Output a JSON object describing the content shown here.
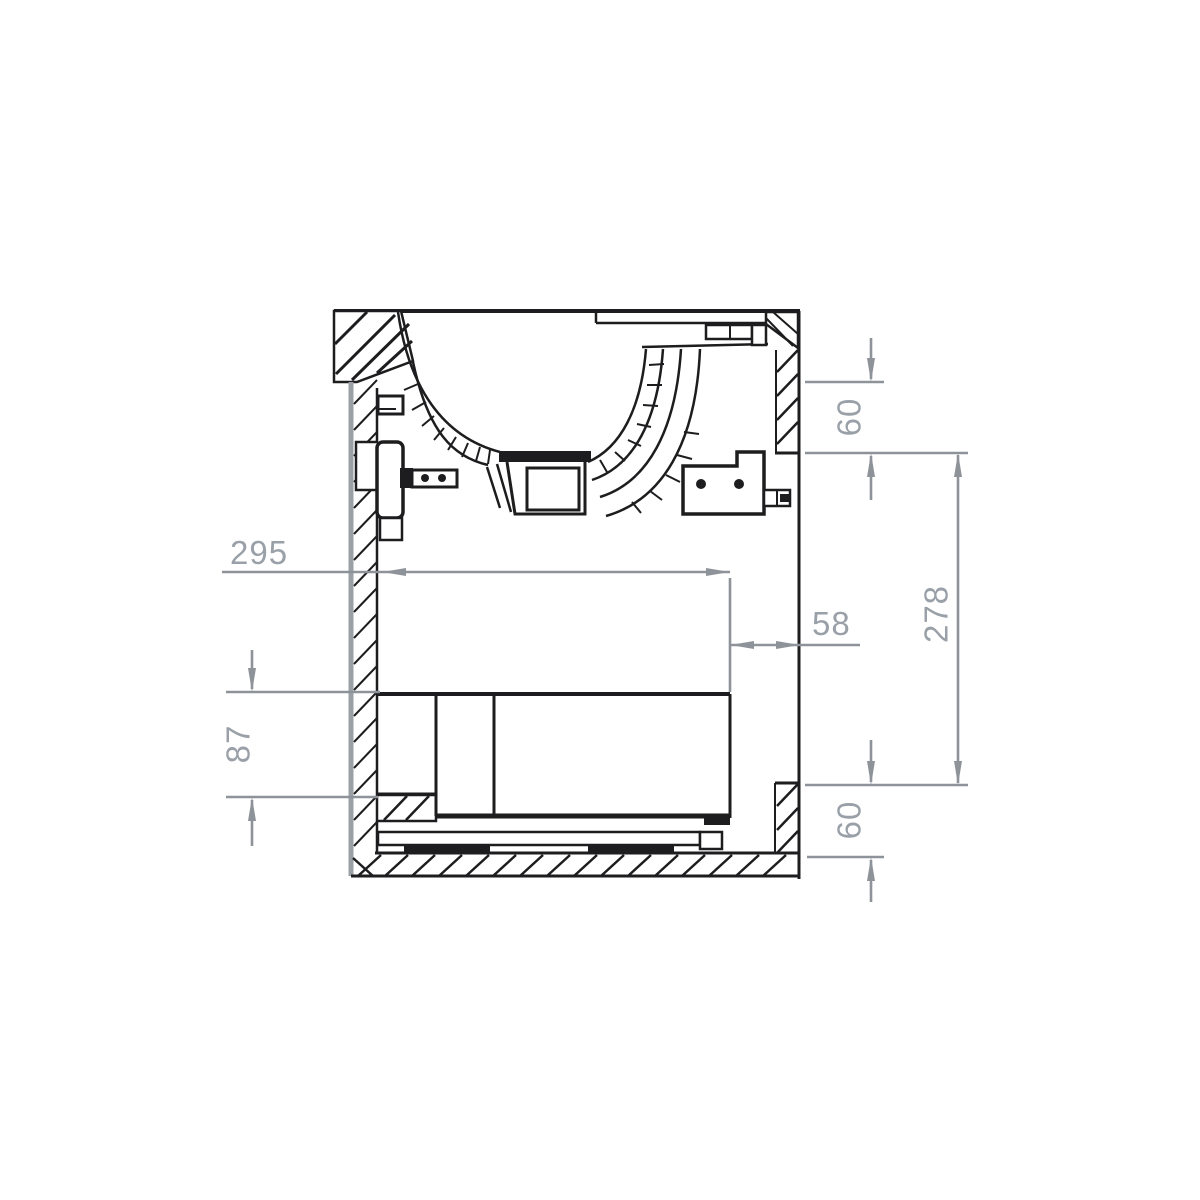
{
  "drawing": {
    "dimension_labels": {
      "basin_width": "295",
      "back_panel_offset": "58",
      "interior_height": "278",
      "drawer_front_height": "87",
      "top_spacing": "60",
      "bottom_spacing": "60"
    },
    "colors": {
      "ink": "#1d1d1f",
      "dimension_gray": "#8e939a",
      "dimension_text_gray": "#99a0a8",
      "wall_outer_gray": "#9aa0a6",
      "background": "#ffffff"
    }
  }
}
